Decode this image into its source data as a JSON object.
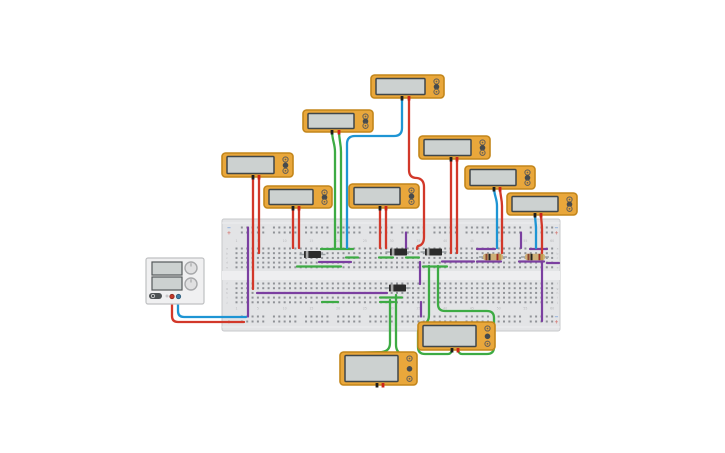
{
  "canvas": {
    "width": 725,
    "height": 453,
    "background": "#ffffff"
  },
  "colors": {
    "red": "#d2382a",
    "blue": "#1e95d4",
    "green": "#3dab44",
    "purple": "#7b3fa0",
    "board": "#e3e4e6",
    "board_edge": "#c7c8cb",
    "groove": "#eeeef0",
    "hole": "#8f9297",
    "meter_body": "#e9a73b",
    "meter_border": "#c3861b",
    "meter_screen": "#ccd1d0",
    "meter_screen_border": "#40474a",
    "probe_black": "#1d1d1d",
    "probe_red": "#cc2418",
    "psu_body": "#f0f0f1",
    "psu_border": "#bfc0c2",
    "psu_screen": "#ccd1d0",
    "psu_screen_border": "#55595b",
    "diode_body": "#2b2b2b",
    "diode_band": "#a9a9a9",
    "lead": "#9aa0a3",
    "resistor_body": "#cdb078",
    "label_minus": "#5b8fd4",
    "label_plus": "#d4736d",
    "tiny_text": "#b7b8bb"
  },
  "breadboard": {
    "x": 222,
    "y": 219,
    "w": 338,
    "h": 112,
    "cols": 60,
    "col0": 236.5,
    "pitch": 5.35,
    "rail_rows_top": [
      227.5,
      232.5
    ],
    "rail_rows_bottom": [
      316.5,
      321.5
    ],
    "bank_top_rows": [
      248.5,
      253.2,
      257.9,
      262.6,
      267.3
    ],
    "bank_bottom_rows": [
      283.5,
      288.2,
      292.9,
      297.6,
      302.3
    ],
    "groove": {
      "y": 271,
      "h": 9
    },
    "number_rows": [
      241,
      308.5
    ],
    "column_numbers": [
      "1",
      "5",
      "10",
      "15",
      "20",
      "25",
      "30",
      "35",
      "40",
      "45",
      "50",
      "55",
      "60"
    ],
    "row_letters_top": [
      "a",
      "b",
      "c",
      "d",
      "e"
    ],
    "row_letters_bottom": [
      "f",
      "g",
      "h",
      "i",
      "j"
    ],
    "labels": {
      "minus": "−",
      "plus": "+"
    }
  },
  "power_supply": {
    "x": 146,
    "y": 258,
    "w": 58,
    "h": 46,
    "displays": [
      {
        "x": 152,
        "y": 262,
        "w": 30,
        "h": 13
      },
      {
        "x": 152,
        "y": 277,
        "w": 30,
        "h": 13
      }
    ],
    "knobs": [
      {
        "cx": 191,
        "cy": 268,
        "r": 6
      },
      {
        "cx": 191,
        "cy": 284,
        "r": 6
      }
    ],
    "power_button": {
      "x": 149,
      "y": 293,
      "w": 13,
      "h": 6
    },
    "aux_button": {
      "cx": 167,
      "cy": 296,
      "r": 1.5
    },
    "terminals": [
      {
        "cx": 172,
        "cy": 296.5,
        "color": "#c4392b",
        "ring": "#8d2a20"
      },
      {
        "cx": 178.5,
        "cy": 296.5,
        "color": "#3f7ea6",
        "ring": "#2c5b79"
      }
    ]
  },
  "multimeters": [
    {
      "id": "multimeter-1",
      "x": 371,
      "y": 75,
      "w": 73,
      "h": 23,
      "probes": [
        402,
        409
      ]
    },
    {
      "id": "multimeter-2",
      "x": 303,
      "y": 110,
      "w": 70,
      "h": 22,
      "probes": [
        332,
        339
      ]
    },
    {
      "id": "multimeter-3",
      "x": 222,
      "y": 153,
      "w": 71,
      "h": 24,
      "probes": [
        253,
        259
      ]
    },
    {
      "id": "multimeter-4",
      "x": 264,
      "y": 186,
      "w": 68,
      "h": 22,
      "probes": [
        293,
        299
      ]
    },
    {
      "id": "multimeter-5",
      "x": 349,
      "y": 184,
      "w": 70,
      "h": 24,
      "probes": [
        380,
        386
      ]
    },
    {
      "id": "multimeter-6",
      "x": 419,
      "y": 136,
      "w": 71,
      "h": 23,
      "probes": [
        451,
        457
      ]
    },
    {
      "id": "multimeter-7",
      "x": 465,
      "y": 166,
      "w": 70,
      "h": 23,
      "probes": [
        494,
        500
      ]
    },
    {
      "id": "multimeter-8",
      "x": 507,
      "y": 193,
      "w": 70,
      "h": 22,
      "probes": [
        535,
        541
      ]
    },
    {
      "id": "multimeter-9",
      "x": 418,
      "y": 322,
      "w": 77,
      "h": 28,
      "probes": [
        452,
        458
      ]
    },
    {
      "id": "multimeter-10",
      "x": 340,
      "y": 352,
      "w": 77,
      "h": 33,
      "probes": [
        377,
        383
      ]
    }
  ],
  "components": {
    "diodes": [
      {
        "id": "diode-1",
        "x": 304,
        "cy": 254.5,
        "w": 17
      },
      {
        "id": "diode-2",
        "x": 390,
        "cy": 252,
        "w": 17
      },
      {
        "id": "diode-3",
        "x": 425,
        "cy": 252,
        "w": 17
      },
      {
        "id": "diode-4",
        "x": 389,
        "cy": 288,
        "w": 17
      }
    ],
    "resistors": [
      {
        "id": "resistor-1",
        "x": 483,
        "cy": 257,
        "w": 20,
        "bands": [
          {
            "dx": 3.5,
            "c": "#8a4632"
          },
          {
            "dx": 6.5,
            "c": "#232323"
          },
          {
            "dx": 14.5,
            "c": "#9c2e24"
          },
          {
            "dx": 17,
            "c": "#c19a4d"
          }
        ]
      },
      {
        "id": "resistor-2",
        "x": 525,
        "cy": 257,
        "w": 20,
        "bands": [
          {
            "dx": 3.5,
            "c": "#8a4632"
          },
          {
            "dx": 6.5,
            "c": "#232323"
          },
          {
            "dx": 14.5,
            "c": "#9c2e24"
          },
          {
            "dx": 17,
            "c": "#c19a4d"
          }
        ]
      }
    ]
  },
  "wires": {
    "jumpers": [
      {
        "name": "wire-rail-left-purple",
        "color": "purple",
        "d": "M248,227.5 V316.5"
      },
      {
        "name": "wire-row-h-purple",
        "color": "purple",
        "d": "M257,293 H387"
      },
      {
        "name": "wire-row-e-green-left",
        "color": "green",
        "d": "M297,266.5 H341"
      },
      {
        "name": "wire-row-d-purple-left",
        "color": "purple",
        "d": "M319,262 H351"
      },
      {
        "name": "wire-row-a-green",
        "color": "green",
        "d": "M321,249 H353"
      },
      {
        "name": "wire-row-c-green-1",
        "color": "green",
        "d": "M346,257.5 H358"
      },
      {
        "name": "wire-row-c-green-2",
        "color": "green",
        "d": "M379,257.5 H393"
      },
      {
        "name": "wire-row-c-green-3",
        "color": "green",
        "d": "M406,257.5 H419"
      },
      {
        "name": "wire-row-d-purple-mid",
        "color": "purple",
        "d": "M442,261.5 H474"
      },
      {
        "name": "wire-row-e-green-mid",
        "color": "green",
        "d": "M423,266.5 H447"
      },
      {
        "name": "wire-row-i-green",
        "color": "green",
        "d": "M380,297.5 H402"
      },
      {
        "name": "wire-row-j-green-1",
        "color": "green",
        "d": "M380,302 H394"
      },
      {
        "name": "wire-row-j-green-2",
        "color": "green",
        "d": "M322,302 H338"
      },
      {
        "name": "wire-vert-purple-1",
        "color": "purple",
        "d": "M406,232.5 V248"
      },
      {
        "name": "wire-vert-purple-2",
        "color": "purple",
        "d": "M420,262 V284"
      },
      {
        "name": "wire-vert-purple-3",
        "color": "purple",
        "d": "M421,302 V316.5"
      },
      {
        "name": "wire-vert-purple-4",
        "color": "purple",
        "d": "M521,232.5 V248"
      },
      {
        "name": "wire-row-a-purple-1",
        "color": "purple",
        "d": "M477,249 H495"
      },
      {
        "name": "wire-row-a-purple-2",
        "color": "purple",
        "d": "M530,249 H547"
      },
      {
        "name": "wire-row-d-purple-r1",
        "color": "purple",
        "d": "M477,261.5 H501"
      },
      {
        "name": "wire-row-d-purple-r2",
        "color": "purple",
        "d": "M519,261.5 H544"
      },
      {
        "name": "wire-vert-purple-right",
        "color": "purple",
        "d": "M542,259 V321"
      },
      {
        "name": "wire-row-d-purple-far",
        "color": "purple",
        "d": "M547,263 H559"
      }
    ],
    "probe_wires": [
      {
        "name": "wire-mm1-blue",
        "color": "blue",
        "d": "M402,96 V128 Q402,136 394,136 H355 Q347,136 347,144 V248"
      },
      {
        "name": "wire-mm1-red",
        "color": "red",
        "d": "M409,96 V170 Q409,178 417,178 Q424,179 424,187 V237 Q424,245 418,246 Q417,247 417,249"
      },
      {
        "name": "wire-mm2-green-1",
        "color": "green",
        "d": "M332,130 C332,141 335,143 335,152 V248"
      },
      {
        "name": "wire-mm2-green-2",
        "color": "green",
        "d": "M339,130 C339,141 341,143 341,152 V248"
      },
      {
        "name": "wire-mm3-red-1",
        "color": "red",
        "d": "M253,175 V289"
      },
      {
        "name": "wire-mm3-red-2",
        "color": "red",
        "d": "M259,175 V253"
      },
      {
        "name": "wire-mm4-red-1",
        "color": "red",
        "d": "M293,206 V248"
      },
      {
        "name": "wire-mm4-red-2",
        "color": "red",
        "d": "M299,206 V248"
      },
      {
        "name": "wire-mm5-red-1",
        "color": "red",
        "d": "M380,206 V248"
      },
      {
        "name": "wire-mm5-red-2",
        "color": "red",
        "d": "M386,206 V248"
      },
      {
        "name": "wire-mm6-red-1",
        "color": "red",
        "d": "M451,157 V253"
      },
      {
        "name": "wire-mm6-red-2",
        "color": "red",
        "d": "M457,157 V253"
      },
      {
        "name": "wire-mm7-blue",
        "color": "blue",
        "d": "M494,187 C494,196 497,198 497,206 V248"
      },
      {
        "name": "wire-mm7-red",
        "color": "red",
        "d": "M500,187 C500,196 502,198 502,206 V253"
      },
      {
        "name": "wire-mm8-blue",
        "color": "blue",
        "d": "M535,213 C535,221 536,223 536,229 V248"
      },
      {
        "name": "wire-mm8-red",
        "color": "red",
        "d": "M541,213 C541,221 542,223 542,229 V253"
      },
      {
        "name": "wire-mm9-green-1",
        "color": "green",
        "d": "M429,266 V315 Q429,322 424,324 Q418,327 418,333 V347 Q418,354 425,354 H448 Q451,354 452,350"
      },
      {
        "name": "wire-mm9-green-2",
        "color": "green",
        "d": "M438,266 V304 Q438,311 445,311 H487 Q494,311 494,318 V347 Q494,354 487,354 H462 Q459,354 458,350"
      },
      {
        "name": "wire-mm10-green-1",
        "color": "green",
        "d": "M390,300 V343 Q390,351 382,352 L351,353 Q344,353 344,360 V377 Q344,384 351,384 H372 Q376,384 377,380"
      },
      {
        "name": "wire-mm10-green-2",
        "color": "green",
        "d": "M396,295 V345 Q396,353 404,355 L409,356 Q415,358 415,364 V377 Q415,384 408,384 H388 Q384,384 383,380"
      },
      {
        "name": "wire-psu-red",
        "color": "red",
        "d": "M172,298 V316 Q172,322 178,322 H244"
      },
      {
        "name": "wire-psu-blue",
        "color": "blue",
        "d": "M178,298 V311 Q178,317 184,317 H246"
      }
    ]
  }
}
